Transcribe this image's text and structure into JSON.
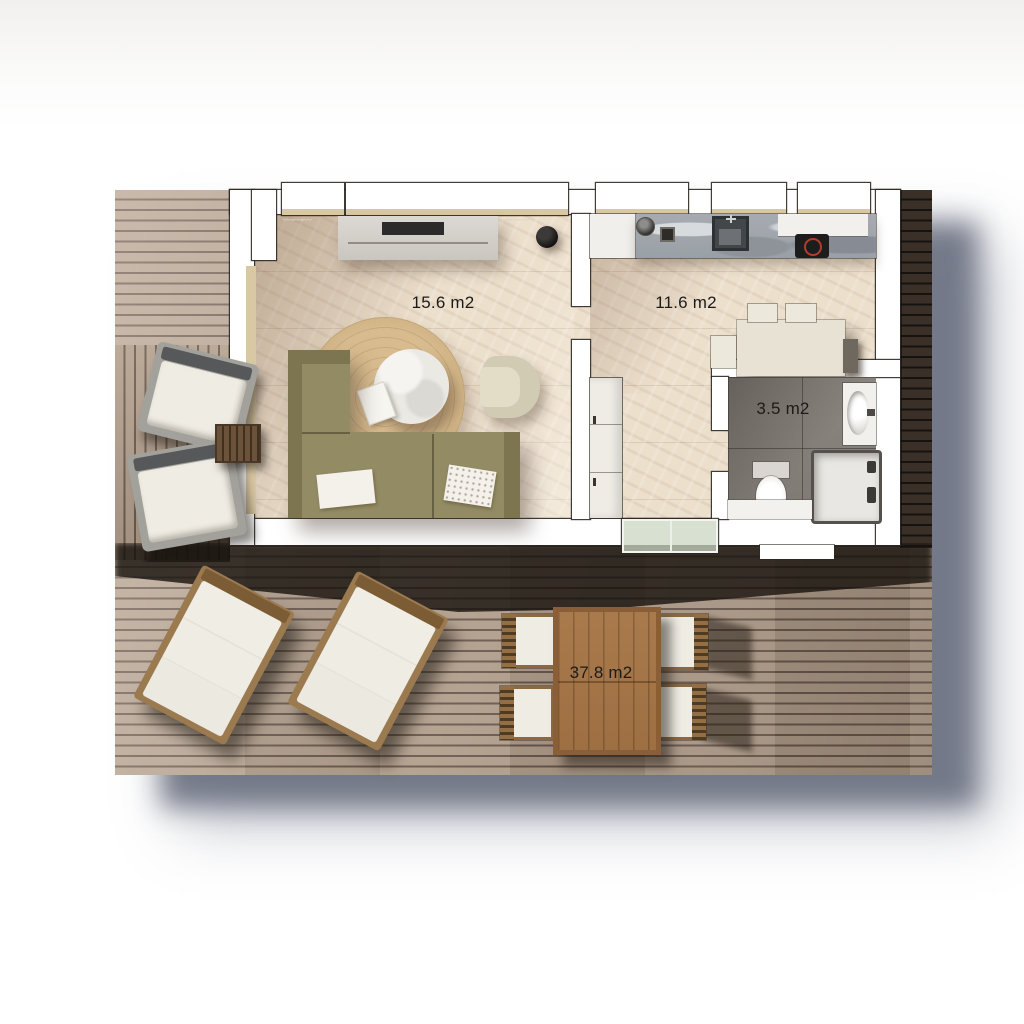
{
  "plan": {
    "rooms": {
      "living_room": {
        "area": "15.6 m2"
      },
      "kitchen": {
        "area": "11.6 m2"
      },
      "bathroom": {
        "area": "3.5 m2"
      },
      "terrace": {
        "area": "37.8 m2"
      }
    },
    "curtain_glyphs": "﹏﹏﹏"
  },
  "colors": {
    "deck_light": "#b3a08e",
    "deck_gap": "#6b5a4e",
    "deck_dark": "#16120f",
    "floor_light": "#ecdfcc",
    "sill_beige": "#d9c8a4",
    "wall_white": "#ffffff",
    "wall_line": "#2c2822",
    "sofa": "#938b63",
    "armchair": "#d2cbb4",
    "rug": "#d3b586",
    "counter_marble": "#a7abb1",
    "hob_black": "#1d1d1d",
    "hob_ring": "#b23c2e",
    "bath_floor": "#8b8680",
    "outdoor_wood": "#a97a4c",
    "lounger_cushion": "#efece4",
    "drop_shadow": "#7e8494",
    "label_color": "#1d1b18"
  }
}
